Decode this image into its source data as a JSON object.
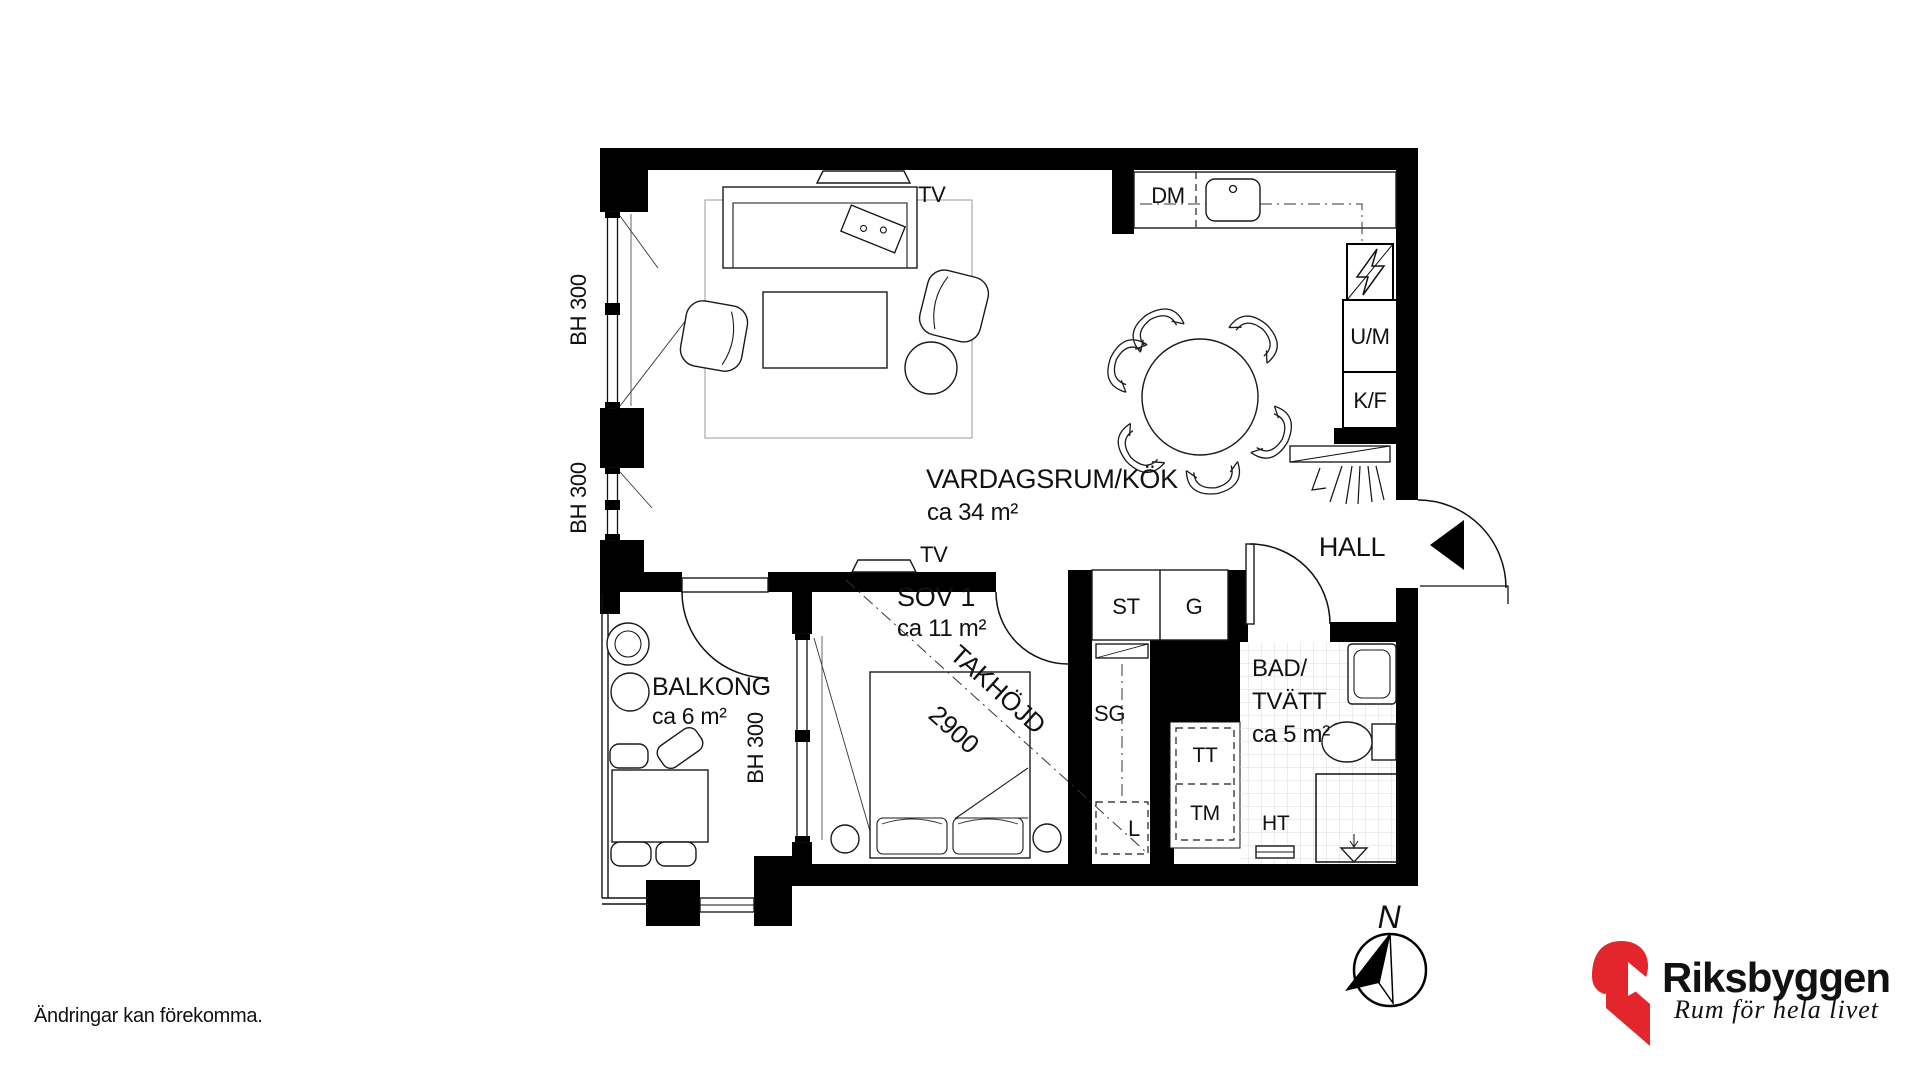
{
  "disclaimer": "Ändringar kan förekomma.",
  "rooms": {
    "living": {
      "name": "VARDAGSRUM/KÖK",
      "area": "ca 34 m²"
    },
    "bedroom": {
      "name": "SOV 1",
      "area": "ca 11 m²"
    },
    "balcony": {
      "name": "BALKONG",
      "area": "ca 6 m²"
    },
    "bathroom": {
      "name_line1": "BAD/",
      "name_line2": "TVÄTT",
      "area": "ca 5 m²"
    },
    "hall": {
      "name": "HALL"
    }
  },
  "fixtures": {
    "dm": "DM",
    "um": "U/M",
    "kf": "K/F",
    "st": "ST",
    "g": "G",
    "sg": "SG",
    "l": "L",
    "tt": "TT",
    "tm": "TM",
    "ht": "HT",
    "tv_living": "TV",
    "tv_bedroom": "TV"
  },
  "annotations": {
    "bh300_upper": "BH 300",
    "bh300_lower": "BH 300",
    "bh300_bedroom": "BH 300",
    "ceiling_label": "TAKHÖJD",
    "ceiling_height": "2900",
    "north": "N"
  },
  "logo": {
    "brand": "Riksbyggen",
    "tagline": "Rum för hela livet",
    "brand_color": "#E2262C",
    "text_color": "#9B9B9B"
  },
  "colors": {
    "wall": "#000000",
    "tile_line": "#D9D9D9"
  }
}
